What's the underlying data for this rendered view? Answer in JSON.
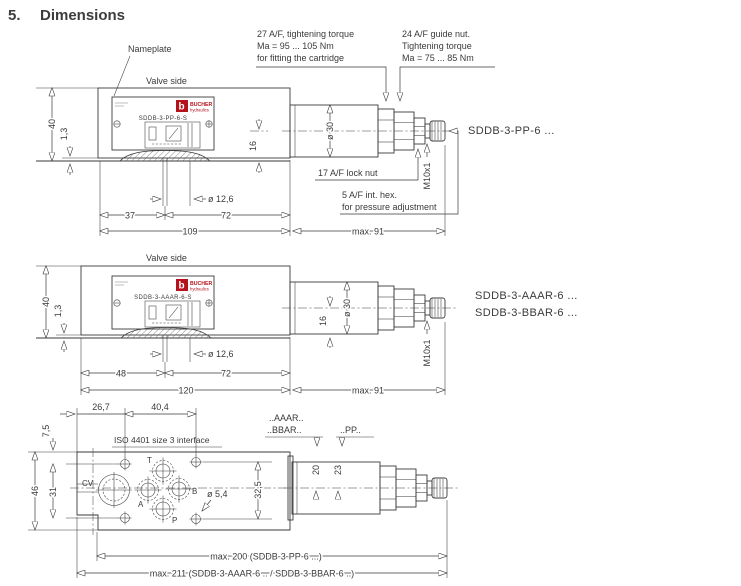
{
  "title": {
    "number": "5.",
    "text": "Dimensions"
  },
  "labels": {
    "nameplate": "Nameplate",
    "valve_side": "Valve side"
  },
  "logo": {
    "mark": "b",
    "name": "BUCHER",
    "sub": "hydraulics"
  },
  "callouts": {
    "cartridge_torque": [
      "27 A/F, tightening torque",
      "Ma = 95 ... 105 Nm",
      "for fitting the cartridge"
    ],
    "guide_nut": [
      "24 A/F guide nut.",
      "Tightening torque",
      "Ma = 75 ... 85 Nm"
    ],
    "lock_nut": "17 A/F lock nut",
    "int_hex": [
      "5 A/F int. hex.",
      "for pressure adjustment"
    ]
  },
  "drawing1": {
    "plate": "SDDB-3-PP-6-S",
    "model": "SDDB-3-PP-6 ...",
    "dims": {
      "height": "40",
      "seal": "1,3",
      "bore": "16",
      "diameter": "ø 30",
      "thread": "M10x1",
      "a": "37",
      "b": "72",
      "total": "109",
      "max": "max. 91",
      "pin": "ø 12,6"
    }
  },
  "drawing2": {
    "plate": "SDDB-3-AAAR-6-S",
    "model_a": "SDDB-3-AAAR-6 ...",
    "model_b": "SDDB-3-BBAR-6 ...",
    "dims": {
      "height": "40",
      "seal": "1,3",
      "bore": "16",
      "diameter": "ø 30",
      "thread": "M10x1",
      "a": "48",
      "b": "72",
      "total": "120",
      "max": "max. 91",
      "pin": "ø 12,6"
    }
  },
  "drawing3": {
    "interface": "ISO 4401 size 3 interface",
    "variants": {
      "a": "..AAAR..",
      "b": "..BBAR..",
      "p": "..PP.."
    },
    "ports": {
      "t": "T",
      "a": "A",
      "b": "B",
      "p": "P",
      "cv": "CV"
    },
    "dims": {
      "a": "26,7",
      "b": "40,4",
      "top": "7,5",
      "height": "46",
      "rows_left": "31",
      "rows_right": "32,5",
      "bolt": "ø 5,4",
      "d20": "20",
      "d23": "23",
      "max_pp": "max. 200 (SDDB-3-PP-6 ...)",
      "max_ar": "max. 211 (SDDB-3-AAAR-6 .. / SDDB-3-BBAR-6 ..)"
    }
  }
}
